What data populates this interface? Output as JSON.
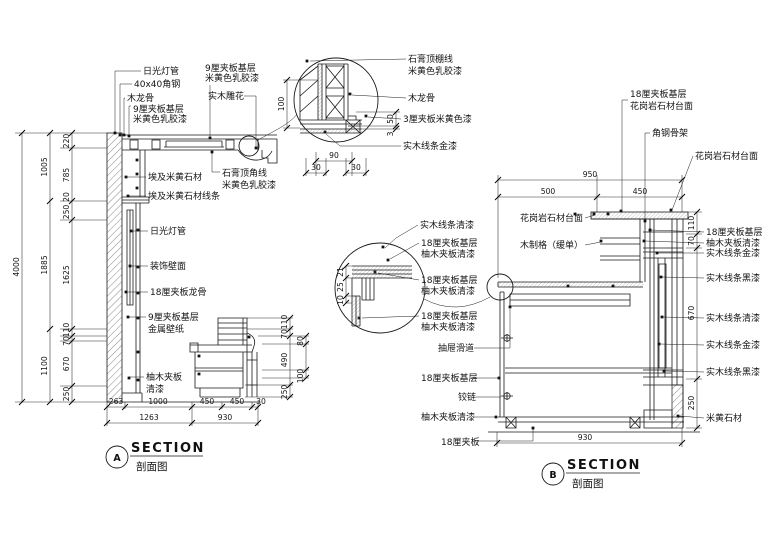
{
  "a": {
    "marker": "A",
    "section": "SECTION",
    "caption": "剖面图",
    "top": [
      "日光灯管",
      "40x40角钢",
      "木龙骨",
      "9厘夹板基层",
      "米黄色乳胶漆"
    ],
    "top2": [
      "9厘夹板基层",
      "米黄色乳胶漆",
      "实木雕花"
    ],
    "cornice": [
      "石膏顶角线",
      "米黄色乳胶漆"
    ],
    "wall": [
      "埃及米黄石材",
      "埃及米黄石材线条",
      "日光灯管",
      "装饰壁面",
      "18厘夹板龙骨",
      "9厘夹板基层",
      "金属壁纸",
      "柚木夹板",
      "清漆"
    ],
    "dimsL": {
      "total": "4000",
      "c1": [
        "1005",
        "1885",
        "1100"
      ],
      "c2": [
        "220",
        "785",
        "20",
        "250",
        "1625",
        "110",
        "70",
        "670",
        "250"
      ]
    },
    "dimsB": [
      "263",
      "1000",
      "450",
      "450",
      "30",
      "1263",
      "930"
    ],
    "dimsCab": [
      "110",
      "70",
      "490",
      "250",
      "80",
      "100"
    ]
  },
  "da": {
    "labels": [
      "石膏顶棚线",
      "米黄色乳胶漆",
      "木龙骨",
      "3厘夹板米黄色漆",
      "实木线条金漆"
    ],
    "dims": [
      "100",
      "50",
      "3",
      "90",
      "30",
      "30"
    ]
  },
  "b": {
    "marker": "B",
    "section": "SECTION",
    "caption": "剖面图",
    "top": [
      "18厘夹板基层",
      "花岗岩石材台面",
      "角钢骨架",
      "花岗岩石材台面",
      "花岗岩石材台面",
      "木制格（缓单）"
    ],
    "left": [
      "实木线条清漆",
      "18厘夹板基层",
      "柚木夹板清漆",
      "18厘夹板基层",
      "柚木夹板清漆",
      "18厘夹板基层",
      "柚木夹板清漆",
      "抽屉滑道",
      "18厘夹板基层",
      "铰链",
      "柚木夹板清漆",
      "18厘夹板"
    ],
    "right": [
      "18厘夹板基层",
      "柚木夹板清漆",
      "实木线条金漆",
      "实木线条黑漆",
      "实木线条清漆",
      "实木线条金漆",
      "实木线条黑漆",
      "米黄石材"
    ],
    "dimsTop": [
      "950",
      "500",
      "450"
    ],
    "dimsR": [
      "110",
      "70",
      "670",
      "250"
    ],
    "dimBottom": "930"
  },
  "db": {
    "dims": [
      "21",
      "25",
      "10"
    ]
  }
}
